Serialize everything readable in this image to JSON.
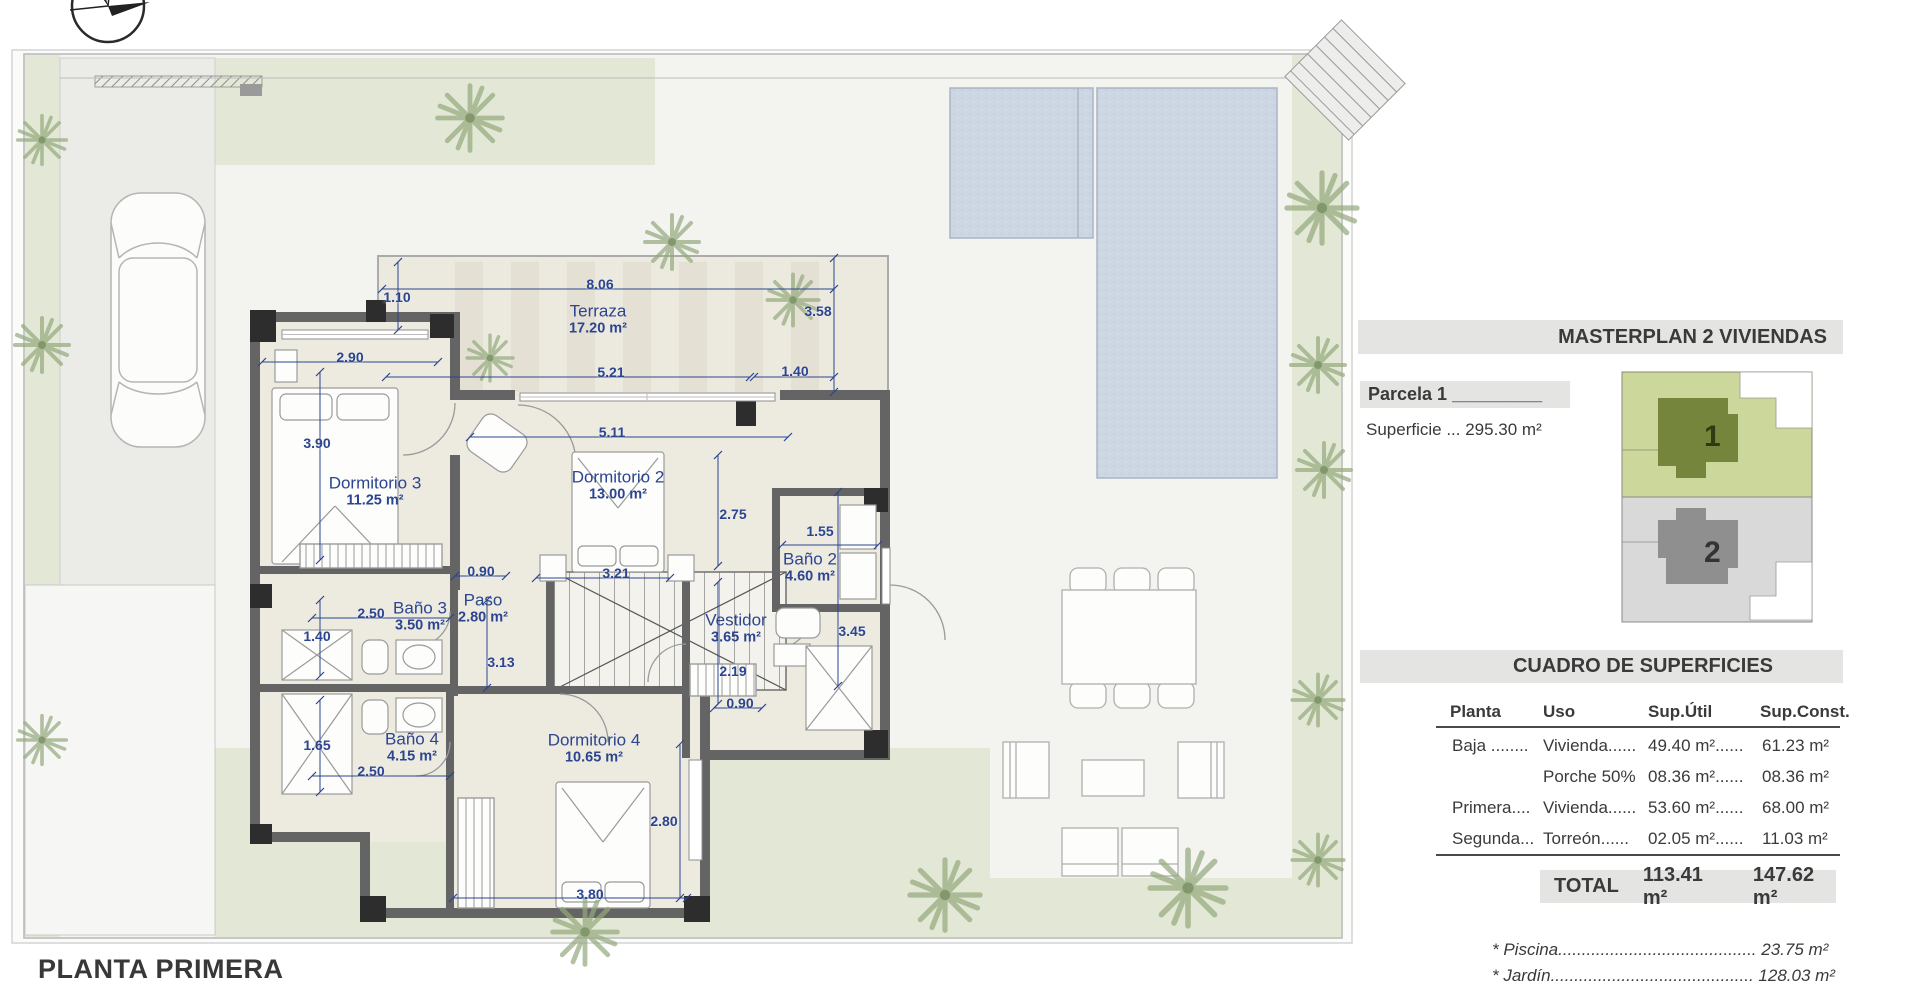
{
  "sheet": {
    "floor_title": "PLANTA PRIMERA"
  },
  "panel": {
    "masterplan_title": "MASTERPLAN 2 VIVIENDAS",
    "parcela_label": "Parcela 1 _________",
    "superficie_label": "Superficie ... 295.30 m²",
    "minimap": {
      "plot1_label": "1",
      "plot2_label": "2"
    },
    "cuadro_title": "CUADRO DE SUPERFICIES",
    "table": {
      "headers": [
        "Planta",
        "Uso",
        "Sup.Útil",
        "Sup.Const."
      ],
      "rows": [
        [
          "Baja ........",
          "Vivienda......",
          "49.40 m²......",
          "61.23 m²"
        ],
        [
          "",
          "Porche 50%",
          "08.36 m²......",
          "08.36 m²"
        ],
        [
          "Primera....",
          "Vivienda......",
          "53.60 m²......",
          "68.00 m²"
        ],
        [
          "Segunda...",
          "Torreón......",
          "02.05 m²......",
          "11.03 m²"
        ]
      ]
    },
    "total": {
      "label": "TOTAL",
      "sup_util": "113.41 m²",
      "sup_const": "147.62 m²"
    },
    "notes": [
      "* Piscina.......................................... 23.75 m²",
      "* Jardín........................................... 128.03 m²"
    ]
  },
  "plan": {
    "rooms": [
      {
        "name": "Terraza",
        "area": "17.20 m²",
        "x": 598,
        "y": 320
      },
      {
        "name": "Dormitorio 3",
        "area": "11.25 m²",
        "x": 375,
        "y": 492
      },
      {
        "name": "Dormitorio 2",
        "area": "13.00 m²",
        "x": 618,
        "y": 486
      },
      {
        "name": "Baño 2",
        "area": "4.60 m²",
        "x": 810,
        "y": 568
      },
      {
        "name": "Baño 3",
        "area": "3.50 m²",
        "x": 420,
        "y": 617
      },
      {
        "name": "Paso",
        "area": "2.80 m²",
        "x": 483,
        "y": 609
      },
      {
        "name": "Vestidor",
        "area": "3.65 m²",
        "x": 736,
        "y": 629
      },
      {
        "name": "Baño 4",
        "area": "4.15 m²",
        "x": 412,
        "y": 748
      },
      {
        "name": "Dormitorio 4",
        "area": "10.65 m²",
        "x": 594,
        "y": 749
      }
    ],
    "dims": [
      {
        "t": "8.06",
        "x": 600,
        "y": 284,
        "l": [
          382,
          289,
          834,
          289
        ]
      },
      {
        "t": "1.10",
        "x": 397,
        "y": 297,
        "l": [
          398,
          262,
          398,
          330
        ]
      },
      {
        "t": "3.58",
        "x": 818,
        "y": 311,
        "l": [
          834,
          258,
          834,
          392
        ]
      },
      {
        "t": "2.90",
        "x": 350,
        "y": 357,
        "l": [
          262,
          362,
          438,
          362
        ]
      },
      {
        "t": "5.21",
        "x": 611,
        "y": 372,
        "l": [
          386,
          377,
          750,
          377
        ]
      },
      {
        "t": "1.40",
        "x": 795,
        "y": 371,
        "l": [
          754,
          377,
          834,
          377
        ]
      },
      {
        "t": "5.11",
        "x": 612,
        "y": 432,
        "l": [
          470,
          437,
          788,
          437
        ]
      },
      {
        "t": "3.90",
        "x": 317,
        "y": 443,
        "l": [
          320,
          372,
          320,
          560
        ]
      },
      {
        "t": "2.75",
        "x": 733,
        "y": 514,
        "l": [
          718,
          455,
          718,
          566
        ]
      },
      {
        "t": "1.55",
        "x": 820,
        "y": 531,
        "l": [
          782,
          545,
          878,
          545
        ]
      },
      {
        "t": "0.90",
        "x": 481,
        "y": 571,
        "l": [
          455,
          576,
          506,
          576
        ]
      },
      {
        "t": "3.21",
        "x": 616,
        "y": 573,
        "l": [
          536,
          578,
          670,
          578
        ]
      },
      {
        "t": "2.50",
        "x": 371,
        "y": 613,
        "l": [
          312,
          618,
          450,
          618
        ]
      },
      {
        "t": "3.13",
        "x": 501,
        "y": 662,
        "l": [
          487,
          600,
          487,
          688
        ]
      },
      {
        "t": "1.40",
        "x": 317,
        "y": 636,
        "l": [
          320,
          600,
          320,
          676
        ]
      },
      {
        "t": "1.65",
        "x": 317,
        "y": 745,
        "l": [
          320,
          700,
          320,
          792
        ]
      },
      {
        "t": "2.50",
        "x": 371,
        "y": 771,
        "l": [
          312,
          776,
          450,
          776
        ]
      },
      {
        "t": "2.19",
        "x": 733,
        "y": 671,
        "l": [
          718,
          582,
          718,
          704
        ]
      },
      {
        "t": "0.90",
        "x": 740,
        "y": 703,
        "l": [
          714,
          708,
          762,
          708
        ]
      },
      {
        "t": "3.45",
        "x": 852,
        "y": 631,
        "l": [
          838,
          492,
          838,
          686
        ]
      },
      {
        "t": "2.80",
        "x": 664,
        "y": 821,
        "l": [
          680,
          744,
          680,
          898
        ]
      },
      {
        "t": "3.80",
        "x": 590,
        "y": 894,
        "l": [
          453,
          898,
          687,
          898
        ]
      }
    ],
    "icons": [
      "compass-icon",
      "palm-tree-icon",
      "car-icon",
      "pool",
      "stairs",
      "dining-table",
      "lounge-set"
    ]
  },
  "colors": {
    "dim_blue": "#2b4590",
    "wall_gray": "#646464",
    "wall_dark": "#2d2d2d",
    "room_fill": "#edeae0",
    "paving": "#f3f3f0",
    "garden_green": "#e2e8d5",
    "pool_blue": "#cdd6e3",
    "minimap_green_light": "#ccd79c",
    "minimap_green_dark": "#75863c",
    "minimap_gray_light": "#d9d9d9",
    "minimap_gray_dark": "#8f8f8f",
    "banner_gray": "#e4e4e3"
  }
}
